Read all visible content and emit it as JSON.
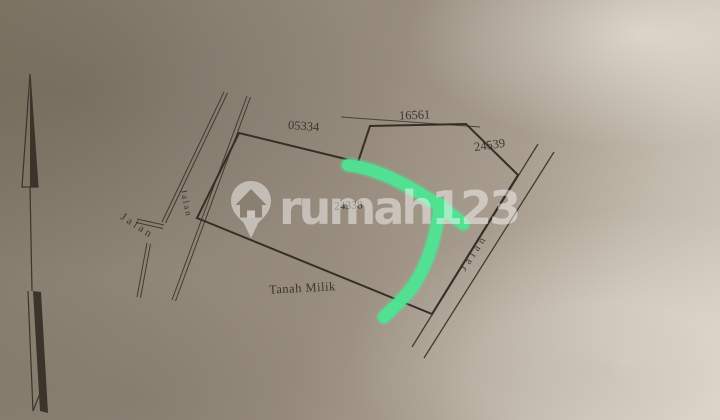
{
  "survey": {
    "parcel_label": "24338",
    "north_boundary_label": "05334",
    "north_jog_label": "16561",
    "northeast_boundary_label": "24539",
    "south_area_label": "Tanah Milik",
    "roads": {
      "left_road_label": "Jalan",
      "branch_road_label": "Jalan",
      "right_road_label": "Jalan"
    }
  },
  "watermark": {
    "brand_text": "rumah123"
  },
  "highlight": {
    "color": "#4fe392",
    "shape": "hand-drawn check stroke"
  },
  "paper": {
    "ink_color": "#3b342b",
    "base_color": "#998e80"
  }
}
